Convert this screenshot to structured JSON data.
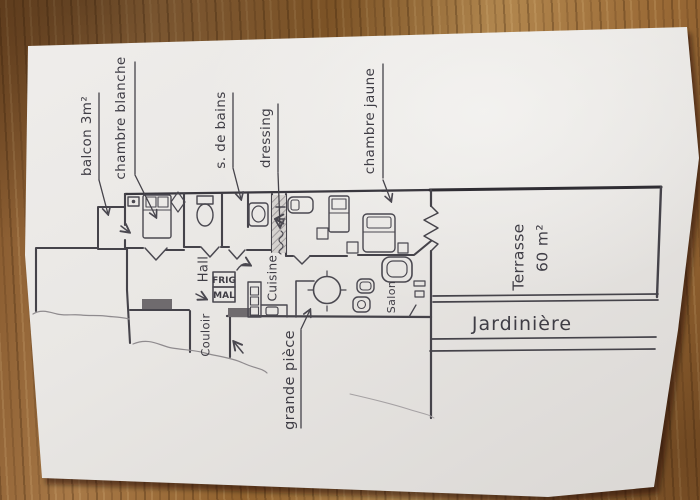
{
  "photo": {
    "description": "hand-drawn apartment floor plan sketch on paper on a wooden table",
    "labels": {
      "balcon": "balcon 3m²",
      "chambre_blanche": "chambre blanche",
      "s_de_bains": "s. de bains",
      "dressing": "dressing",
      "chambre_jaune": "chambre jaune",
      "terrasse": "Terrasse",
      "terrasse_area": "60 m²",
      "jardiniere": "Jardinière",
      "hall": "Hall",
      "frig": "FRIG",
      "mal": "MAL",
      "cuisine": "Cuisine",
      "couloir": "Couloir",
      "salon": "Salon",
      "grande_piece": "grande pièce"
    },
    "colors": {
      "pencil": "#45434a",
      "pencil_dark": "#35333a",
      "paper": "#eae8e5",
      "wood": "#a1703c"
    }
  }
}
